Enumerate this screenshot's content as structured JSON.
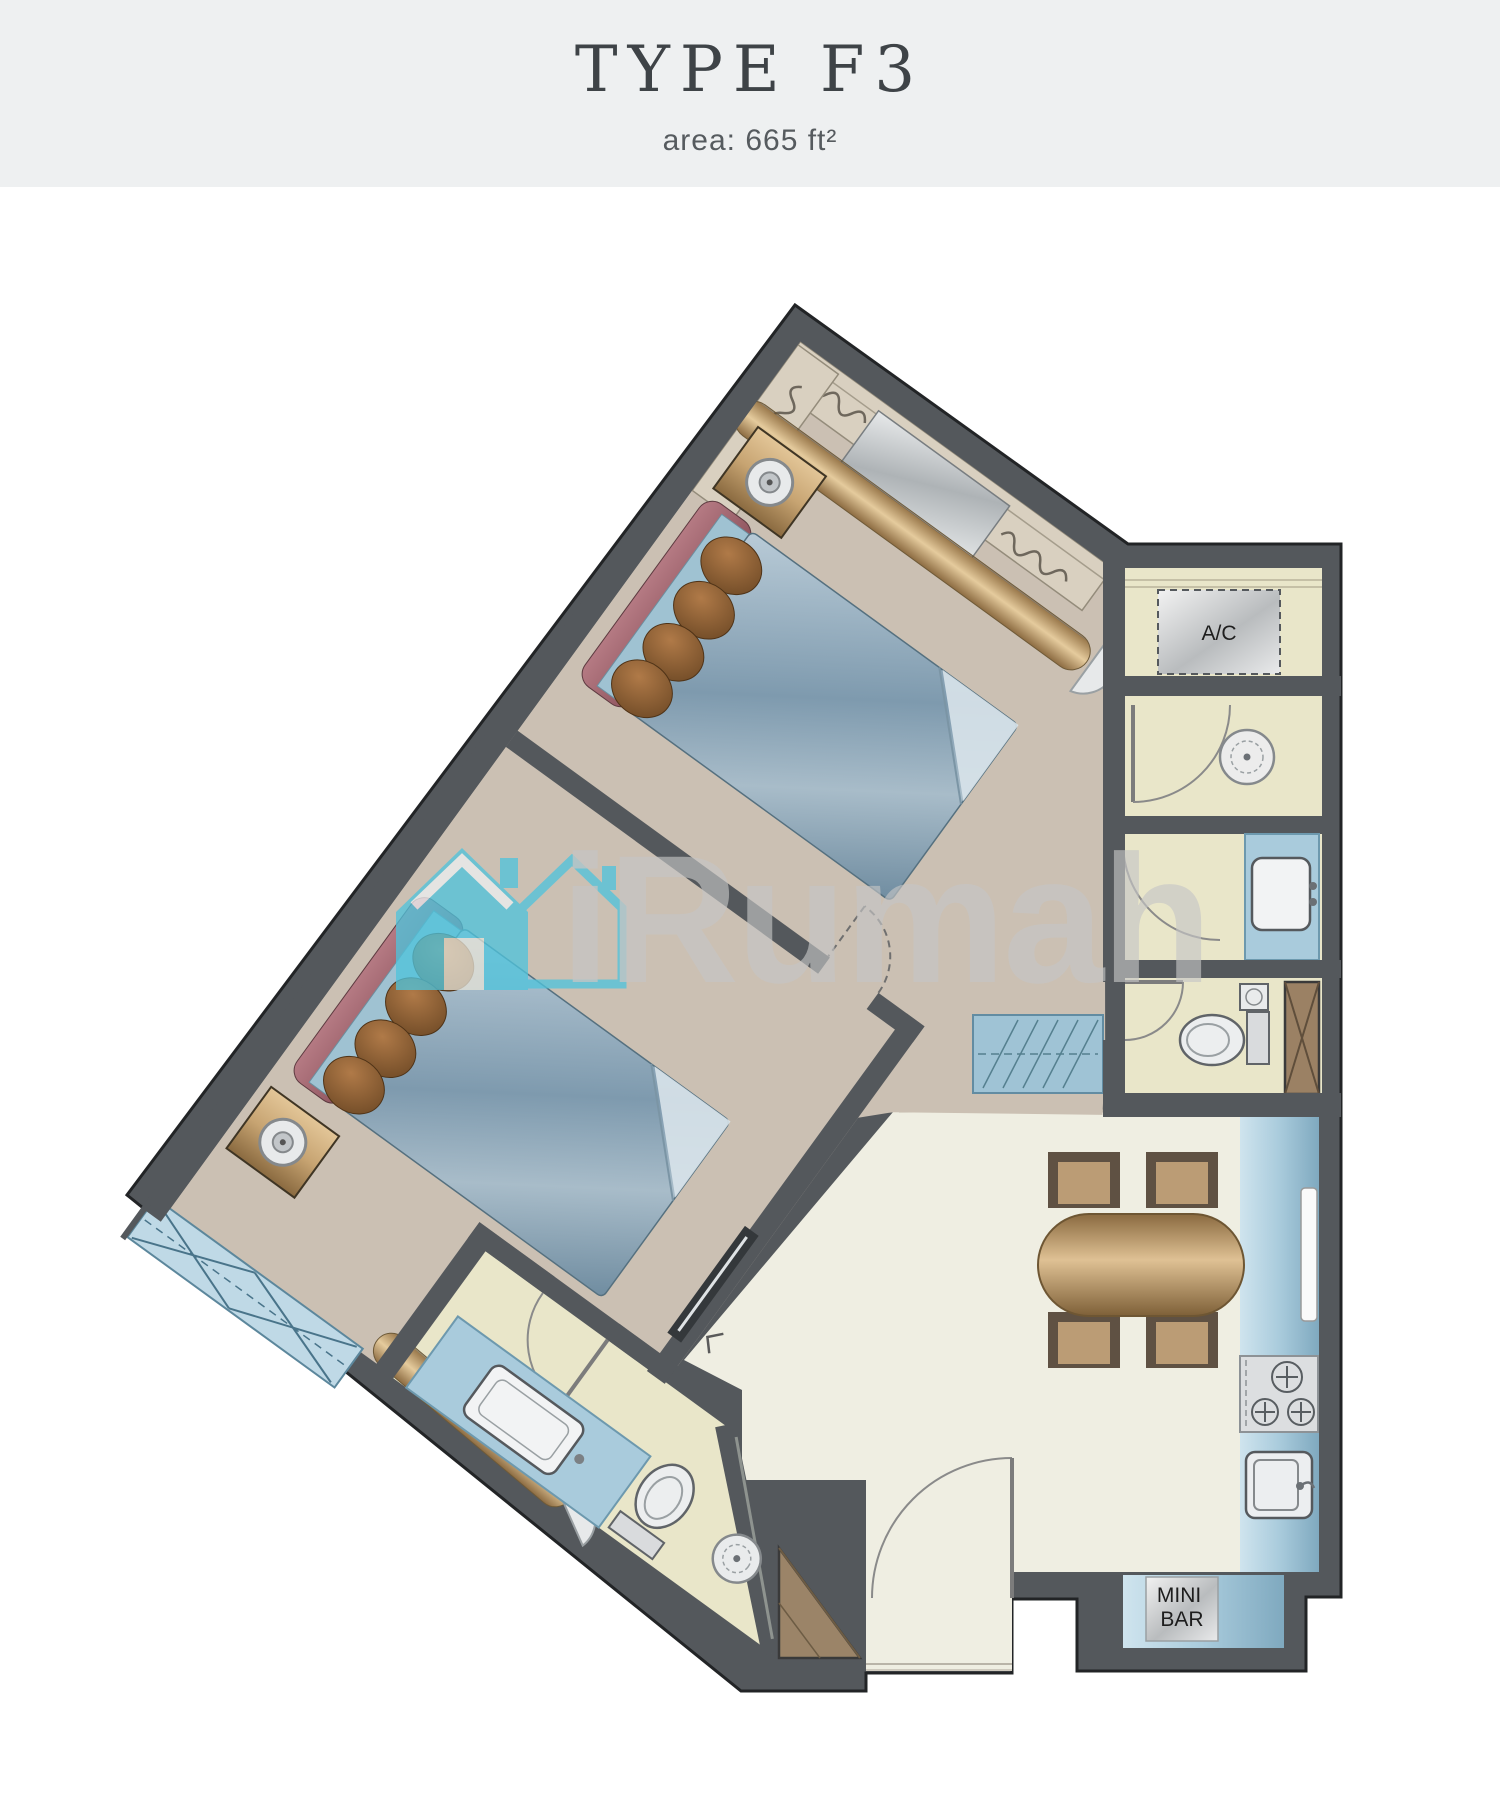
{
  "header": {
    "title": "TYPE F3",
    "area": "area: 665 ft²"
  },
  "plan": {
    "ac_label": "A/C",
    "minibar_line1": "MINI",
    "minibar_line2": "BAR",
    "watermark_text": "iRumah"
  },
  "colors": {
    "header_bg": "#eef0f1",
    "title_text": "#3e4347",
    "wall": "#54585c",
    "bedroom_floor": "#cbc0b3",
    "living_floor": "#efeee2",
    "bath_floor": "#e9e6c9",
    "counter_blue": "#a9cbdc",
    "wood_tan": "#c1a077",
    "bed_blue": "#9db6c6",
    "cushion_maroon": "#a96b74",
    "pillow_brown": "#8a5a35",
    "watermark_cyan": "#4fc4dc",
    "watermark_gray": "#c6c6c6"
  }
}
